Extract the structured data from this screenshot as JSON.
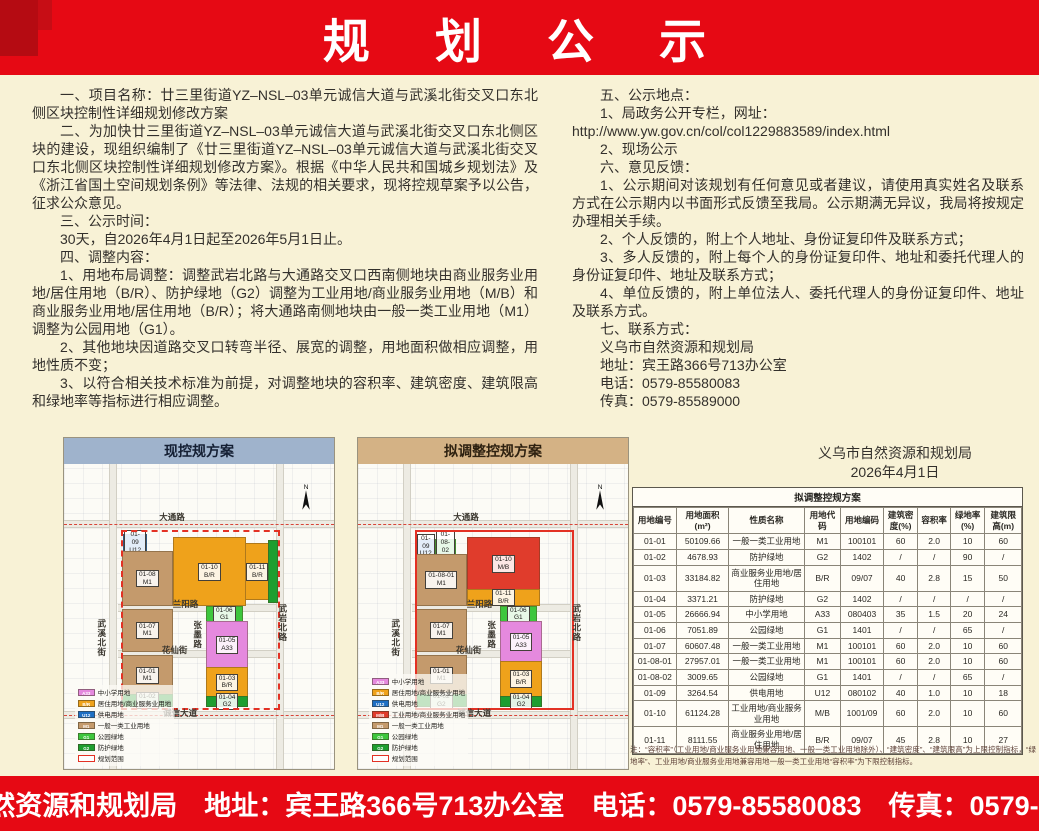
{
  "page": {
    "background": "#f8f2d6",
    "accent_red": "#e60914"
  },
  "header": {
    "title": "规 划 公 示"
  },
  "left_column": {
    "paragraphs": [
      {
        "text": "一、项目名称：廿三里街道YZ–NSL–03单元诚信大道与武溪北街交叉口东北侧区块控制性详细规划修改方案"
      },
      {
        "text": "二、为加快廿三里街道YZ–NSL–03单元诚信大道与武溪北街交叉口东北侧区块的建设，现组织编制了《廿三里街道YZ–NSL–03单元诚信大道与武溪北街交叉口东北侧区块控制性详细规划修改方案》。根据《中华人民共和国城乡规划法》及《浙江省国土空间规划条例》等法律、法规的相关要求，现将控规草案予以公告，征求公众意见。"
      },
      {
        "text": "三、公示时间："
      },
      {
        "text": "30天，自2026年4月1日起至2026年5月1日止。"
      },
      {
        "text": "四、调整内容："
      },
      {
        "text": "1、用地布局调整：调整武岩北路与大通路交叉口西南侧地块由商业服务业用地/居住用地（B/R）、防护绿地（G2）调整为工业用地/商业服务业用地（M/B）和商业服务业用地/居住用地（B/R）；将大通路南侧地块由一般一类工业用地（M1）调整为公园用地（G1）。"
      },
      {
        "text": "2、其他地块因道路交叉口转弯半径、展宽的调整，用地面积做相应调整，用地性质不变；"
      },
      {
        "text": "3、以符合相关技术标准为前提，对调整地块的容积率、建筑密度、建筑限高和绿地率等指标进行相应调整。"
      }
    ]
  },
  "right_column": {
    "paragraphs": [
      {
        "text": "五、公示地点："
      },
      {
        "text": "1、局政务公开专栏，网址："
      },
      {
        "text": "http://www.yw.gov.cn/col/col1229883589/index.html",
        "cls": "url"
      },
      {
        "text": "2、现场公示"
      },
      {
        "text": "六、意见反馈："
      },
      {
        "text": "1、公示期间对该规划有任何意见或者建议，请使用真实姓名及联系方式在公示期内以书面形式反馈至我局。公示期满无异议，我局将按规定办理相关手续。"
      },
      {
        "text": "2、个人反馈的，附上个人地址、身份证复印件及联系方式；"
      },
      {
        "text": "3、多人反馈的，附上每个人的身份证复印件、地址和委托代理人的身份证复印件、地址及联系方式；"
      },
      {
        "text": "4、单位反馈的，附上单位法人、委托代理人的身份证复印件、地址及联系方式。"
      },
      {
        "text": "七、联系方式："
      },
      {
        "text": "义乌市自然资源和规划局"
      },
      {
        "text": "地址：宾王路366号713办公室"
      },
      {
        "text": "电话：0579-85580083"
      },
      {
        "text": "传真：0579-85589000"
      }
    ]
  },
  "signature": {
    "org": "义乌市自然资源和规划局",
    "date": "2026年4月1日"
  },
  "land_colors": {
    "A33": "#e589de",
    "B/R": "#efa21b",
    "U12": "#1e6fc4",
    "M/B": "#e03c2c",
    "M1": "#c49a6c",
    "G1": "#3dc63d",
    "G2": "#1e9e30"
  },
  "maps": {
    "north_label": "N",
    "current": {
      "title": "现控规方案",
      "band_color": "#9fb3cc",
      "boundary_style": "dashed",
      "parcels": [
        {
          "id": "01-09",
          "code": "U12",
          "color": "#1e6fc4",
          "rect": [
            22,
            23,
            8,
            5
          ]
        },
        {
          "id": "01-08",
          "code": "M1",
          "color": "#c49a6c",
          "rect": [
            21.5,
            28.5,
            18,
            17.5
          ]
        },
        {
          "id": "01-10",
          "code": "B/R",
          "color": "#efa21b",
          "rect": [
            40.5,
            24,
            26,
            22
          ]
        },
        {
          "id": "01-11",
          "code": "B/R",
          "color": "#efa21b",
          "rect": [
            67,
            26,
            8.5,
            18
          ]
        },
        {
          "color": "#1e9e30",
          "rect": [
            75.5,
            25,
            3,
            20
          ]
        },
        {
          "id": "01-07",
          "code": "M1",
          "color": "#c49a6c",
          "rect": [
            21.5,
            47.5,
            18,
            13.5
          ]
        },
        {
          "id": "01-06",
          "code": "G1",
          "color": "#3dc63d",
          "rect": [
            52.5,
            46.5,
            13,
            5
          ]
        },
        {
          "id": "01-05",
          "code": "A33",
          "color": "#e589de",
          "rect": [
            52.5,
            51.5,
            15,
            15
          ]
        },
        {
          "id": "01-01",
          "code": "M1",
          "color": "#c49a6c",
          "rect": [
            21.5,
            62.5,
            18,
            13
          ]
        },
        {
          "id": "01-03",
          "code": "B/R",
          "color": "#efa21b",
          "rect": [
            52.5,
            66.5,
            15,
            9.5
          ]
        },
        {
          "id": "01-02",
          "code": "G2",
          "color": "#1e9e30",
          "rect": [
            21.5,
            75.5,
            18,
            3.5
          ]
        },
        {
          "id": "01-04",
          "code": "G2",
          "color": "#1e9e30",
          "rect": [
            52.5,
            76,
            15,
            3
          ]
        }
      ],
      "roads": [
        {
          "label": "大通路",
          "rect": [
            40,
            17.5
          ]
        },
        {
          "label": "武溪北街",
          "rect": [
            14,
            57
          ],
          "cls": "vert"
        },
        {
          "label": "兰阳路",
          "rect": [
            45,
            46
          ]
        },
        {
          "label": "张墨路",
          "rect": [
            49.5,
            56
          ],
          "cls": "vert"
        },
        {
          "label": "花仙街",
          "rect": [
            41,
            61
          ]
        },
        {
          "label": "武岩北路",
          "rect": [
            81,
            52
          ],
          "cls": "vert"
        },
        {
          "label": "诚信大道",
          "rect": [
            43,
            81.5
          ]
        }
      ],
      "legend": [
        {
          "code": "A33",
          "label": "中小学用地",
          "color": "#e589de"
        },
        {
          "code": "B/R",
          "label": "居住用地/商业服务业用地",
          "color": "#efa21b"
        },
        {
          "code": "U12",
          "label": "供电用地",
          "color": "#1e6fc4"
        },
        {
          "code": "M1",
          "label": "一般一类工业用地",
          "color": "#c49a6c"
        },
        {
          "code": "G1",
          "label": "公园绿地",
          "color": "#3dc63d"
        },
        {
          "code": "G2",
          "label": "防护绿地",
          "color": "#1e9e30"
        },
        {
          "code": "",
          "label": "规划范围",
          "color": "#ffffff",
          "cls": "outline"
        }
      ]
    },
    "proposed": {
      "title": "拟调整控规方案",
      "band_color": "#d4b285",
      "boundary_style": "solid",
      "parcels": [
        {
          "id": "01-09",
          "code": "U12",
          "color": "#1e6fc4",
          "rect": [
            21.5,
            24.5,
            6.5,
            4.5
          ]
        },
        {
          "id": "01-08-02",
          "code": "G1",
          "color": "#3dc63d",
          "rect": [
            28.5,
            24.5,
            7,
            4.5
          ]
        },
        {
          "id": "01-08-01",
          "code": "M1",
          "color": "#c49a6c",
          "rect": [
            21.5,
            29.5,
            18,
            16.5
          ]
        },
        {
          "id": "01-10",
          "code": "M/B",
          "color": "#e03c2c",
          "rect": [
            40.5,
            24,
            26,
            17
          ]
        },
        {
          "id": "01-11",
          "code": "B/R",
          "color": "#efa21b",
          "rect": [
            40.5,
            41,
            26,
            5
          ]
        },
        {
          "id": "01-07",
          "code": "M1",
          "color": "#c49a6c",
          "rect": [
            21.5,
            47.5,
            18,
            13.5
          ]
        },
        {
          "id": "01-06",
          "code": "G1",
          "color": "#3dc63d",
          "rect": [
            52.5,
            46.5,
            13,
            5
          ]
        },
        {
          "id": "01-05",
          "code": "A33",
          "color": "#e589de",
          "rect": [
            52.5,
            51.5,
            15,
            13
          ]
        },
        {
          "id": "01-01",
          "code": "M1",
          "color": "#c49a6c",
          "rect": [
            21.5,
            62.5,
            18,
            13
          ]
        },
        {
          "id": "01-03",
          "code": "B/R",
          "color": "#efa21b",
          "rect": [
            52.5,
            64.5,
            15,
            11.5
          ]
        },
        {
          "id": "01-02",
          "code": "G2",
          "color": "#1e9e30",
          "rect": [
            21.5,
            75.5,
            18,
            3.5
          ]
        },
        {
          "id": "01-04",
          "code": "G2",
          "color": "#1e9e30",
          "rect": [
            52.5,
            76,
            15,
            3
          ]
        }
      ],
      "roads": [
        {
          "label": "大通路",
          "rect": [
            40,
            17.5
          ]
        },
        {
          "label": "武溪北街",
          "rect": [
            14,
            57
          ],
          "cls": "vert"
        },
        {
          "label": "兰阳路",
          "rect": [
            45,
            46
          ]
        },
        {
          "label": "张墨路",
          "rect": [
            49.5,
            56
          ],
          "cls": "vert"
        },
        {
          "label": "花仙街",
          "rect": [
            41,
            61
          ]
        },
        {
          "label": "武岩北路",
          "rect": [
            81,
            52
          ],
          "cls": "vert"
        },
        {
          "label": "诚信大道",
          "rect": [
            43,
            81.5
          ]
        }
      ],
      "legend": [
        {
          "code": "A33",
          "label": "中小学用地",
          "color": "#e589de"
        },
        {
          "code": "B/R",
          "label": "居住用地/商业服务业用地",
          "color": "#efa21b"
        },
        {
          "code": "U12",
          "label": "供电用地",
          "color": "#1e6fc4"
        },
        {
          "code": "M/B",
          "label": "工业用地/商业服务业用地",
          "color": "#e03c2c"
        },
        {
          "code": "M1",
          "label": "一般一类工业用地",
          "color": "#c49a6c"
        },
        {
          "code": "G1",
          "label": "公园绿地",
          "color": "#3dc63d"
        },
        {
          "code": "G2",
          "label": "防护绿地",
          "color": "#1e9e30"
        },
        {
          "code": "",
          "label": "规划范围",
          "color": "#ffffff",
          "cls": "outline"
        }
      ]
    }
  },
  "table": {
    "title": "拟调整控规方案",
    "headers": [
      "用地编号",
      "用地面积(m²)",
      "性质名称",
      "用地代码",
      "用地编码",
      "建筑密度(%)",
      "容积率",
      "绿地率(%)",
      "建筑限高(m)"
    ],
    "rows": [
      [
        "01-01",
        "50109.66",
        "一般一类工业用地",
        "M1",
        "100101",
        "60",
        "2.0",
        "10",
        "60"
      ],
      [
        "01-02",
        "4678.93",
        "防护绿地",
        "G2",
        "1402",
        "/",
        "/",
        "90",
        "/"
      ],
      [
        "01-03",
        "33184.82",
        "商业服务业用地/居住用地",
        "B/R",
        "09/07",
        "40",
        "2.8",
        "15",
        "50"
      ],
      [
        "01-04",
        "3371.21",
        "防护绿地",
        "G2",
        "1402",
        "/",
        "/",
        "/",
        "/"
      ],
      [
        "01-05",
        "26666.94",
        "中小学用地",
        "A33",
        "080403",
        "35",
        "1.5",
        "20",
        "24"
      ],
      [
        "01-06",
        "7051.89",
        "公园绿地",
        "G1",
        "1401",
        "/",
        "/",
        "65",
        "/"
      ],
      [
        "01-07",
        "60607.48",
        "一般一类工业用地",
        "M1",
        "100101",
        "60",
        "2.0",
        "10",
        "60"
      ],
      [
        "01-08-01",
        "27957.01",
        "一般一类工业用地",
        "M1",
        "100101",
        "60",
        "2.0",
        "10",
        "60"
      ],
      [
        "01-08-02",
        "3009.65",
        "公园绿地",
        "G1",
        "1401",
        "/",
        "/",
        "65",
        "/"
      ],
      [
        "01-09",
        "3264.54",
        "供电用地",
        "U12",
        "080102",
        "40",
        "1.0",
        "10",
        "18"
      ],
      [
        "01-10",
        "61124.28",
        "工业用地/商业服务业用地",
        "M/B",
        "1001/09",
        "60",
        "2.0",
        "10",
        "60"
      ],
      [
        "01-11",
        "8111.55",
        "商业服务业用地/居住用地",
        "B/R",
        "09/07",
        "45",
        "2.8",
        "10",
        "27"
      ]
    ],
    "note": "注：“容积率”（工业用地/商业服务业用地兼容用地、一般一类工业用地除外）、“建筑密度”、“建筑限高”为上限控制指标，“绿地率”、工业用地/商业服务业用地兼容用地一般一类工业用地“容积率”为下限控制指标。"
  },
  "footer": {
    "text": "义乌市自然资源和规划局　地址：宾王路366号713办公室　电话：0579-85580083　传真：0579-85589000"
  }
}
